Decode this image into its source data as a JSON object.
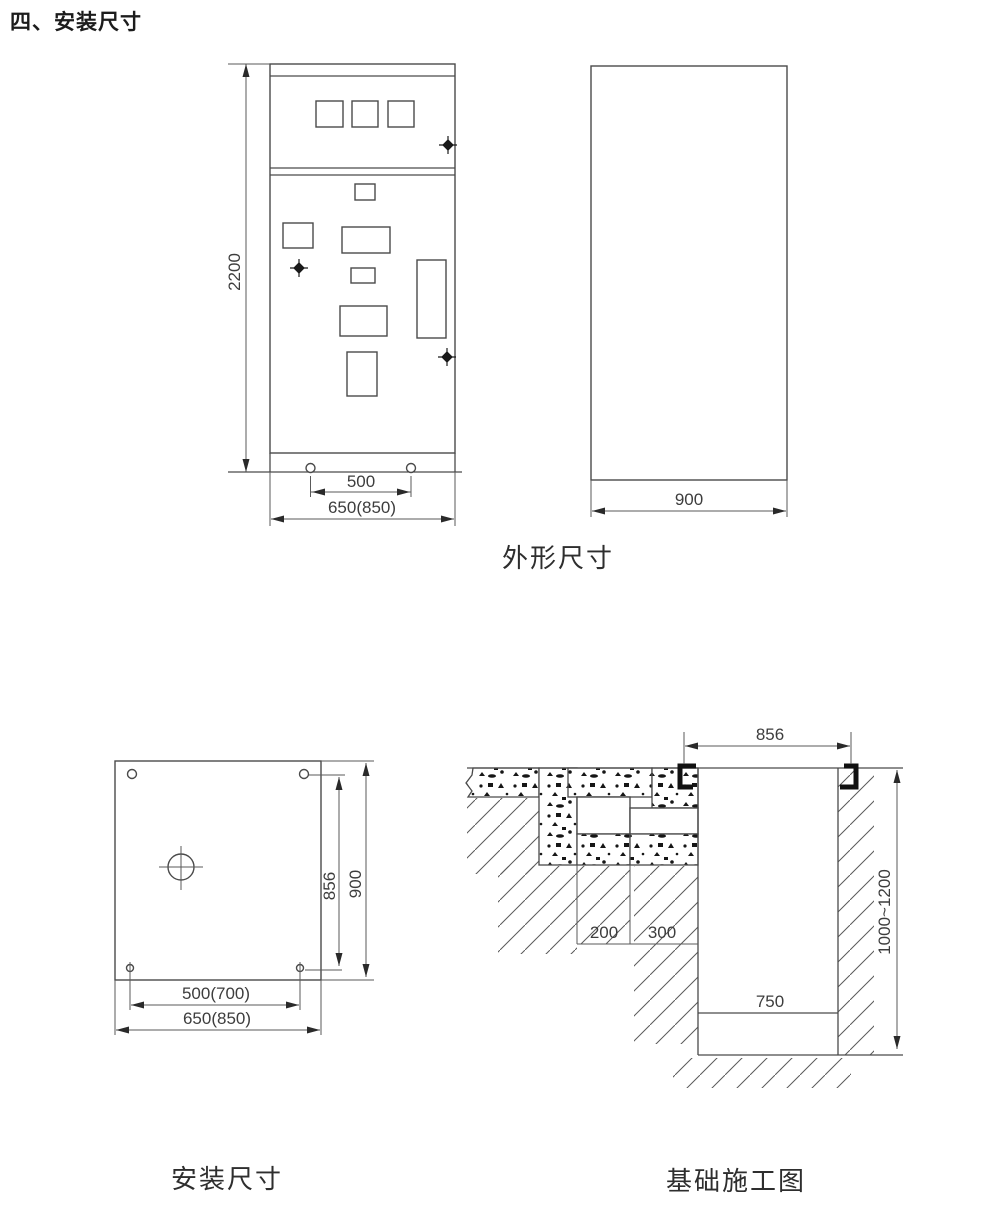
{
  "page": {
    "title": "四、安装尺寸",
    "background": "#ffffff",
    "line_color": "#4a4a4a",
    "text_color": "#3d3d3d"
  },
  "figures": {
    "outline": {
      "caption": "外形尺寸",
      "front_view": {
        "height_dim": "2200",
        "hole_spacing_dim": "500",
        "width_dim": "650(850)"
      },
      "side_view": {
        "depth_dim": "900"
      }
    },
    "installation": {
      "caption": "安装尺寸",
      "dims": {
        "hole_span_vertical": "856",
        "depth": "900",
        "hole_span_horizontal": "500(700)",
        "width": "650(850)"
      }
    },
    "foundation": {
      "caption": "基础施工图",
      "dims": {
        "channel_span": "856",
        "step_left": "200",
        "step_right": "300",
        "pit_width": "750",
        "pit_depth": "1000~1200"
      }
    }
  }
}
